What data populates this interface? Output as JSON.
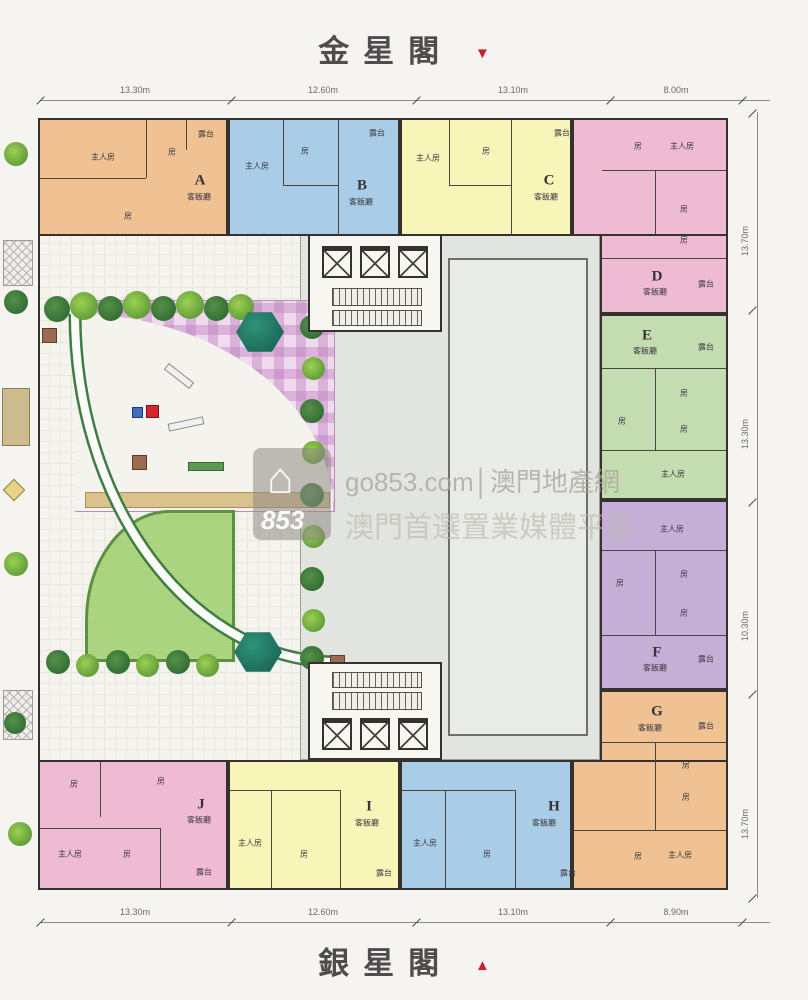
{
  "titles": {
    "top": "金星閣",
    "bottom": "銀星閣"
  },
  "dimensions": {
    "top": [
      "13.30m",
      "12.60m",
      "13.10m",
      "8.00m"
    ],
    "bottom": [
      "13.30m",
      "12.60m",
      "13.10m",
      "8.90m"
    ],
    "right": [
      "13.70m",
      "13.30m",
      "10.30m",
      "13.70m"
    ]
  },
  "labels": {
    "master": "主人房",
    "room": "房",
    "living": "客飯廳",
    "balcony": "露台"
  },
  "units": [
    {
      "id": "A",
      "color": "#efc193"
    },
    {
      "id": "B",
      "color": "#a9cce7"
    },
    {
      "id": "C",
      "color": "#f7f5b8"
    },
    {
      "id": "D",
      "color": "#eebbd2"
    },
    {
      "id": "E",
      "color": "#c3ddb0"
    },
    {
      "id": "F",
      "color": "#c6afd7"
    },
    {
      "id": "G",
      "color": "#efc193"
    },
    {
      "id": "H",
      "color": "#a9cce7"
    },
    {
      "id": "I",
      "color": "#f7f5b8"
    },
    {
      "id": "J",
      "color": "#eebbd2"
    }
  ],
  "watermark": {
    "logo_text": "853",
    "line1": "go853.com│澳門地產網",
    "line2": "澳門首選置業媒體平臺"
  },
  "colors": {
    "wall": "#35312f",
    "title_red": "#c4232b",
    "lawn": "#a9d37d",
    "gazebo": "#14584c",
    "playground": "#f0daee"
  }
}
